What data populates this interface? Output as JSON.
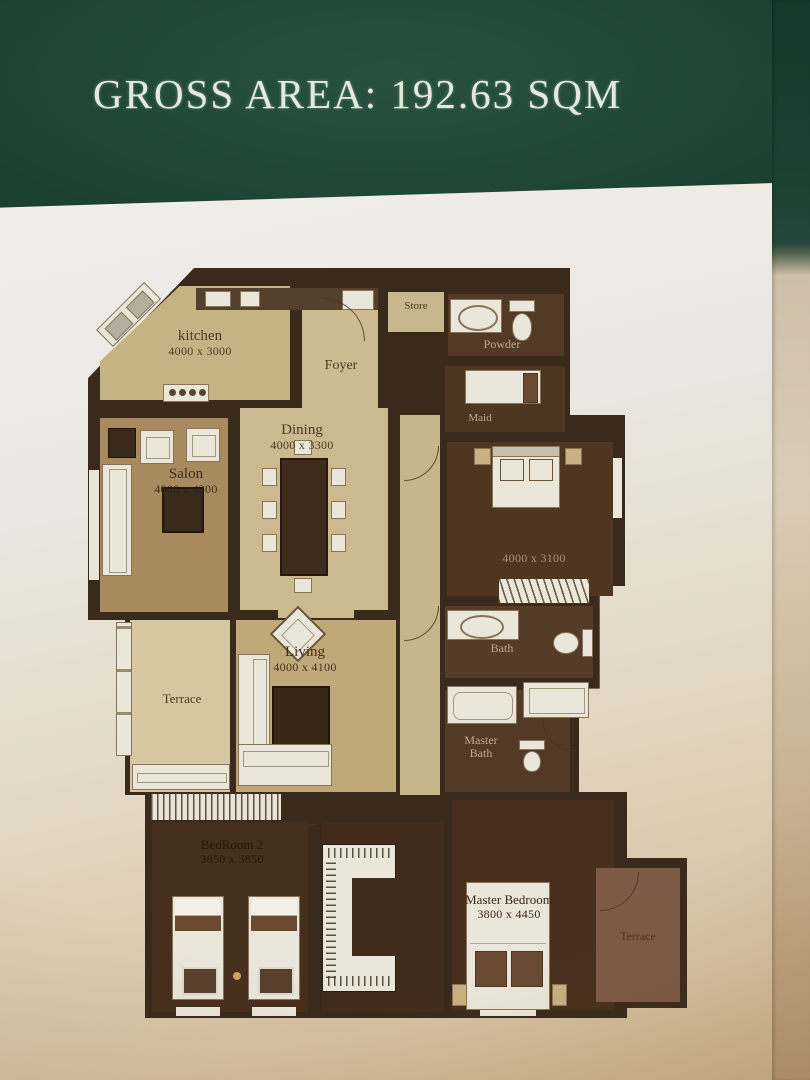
{
  "header": {
    "title": "GROSS AREA: 192.63 SQM"
  },
  "colors": {
    "band_green": "#1e4434",
    "wall_brown": "#3a2a1c",
    "floor_light": "#cdbc92",
    "floor_dark": "#4b3422",
    "furniture_white": "#eae6da",
    "page": "#ece9e2"
  },
  "rooms": {
    "kitchen": {
      "name": "kitchen",
      "dims": "4000 x 3000"
    },
    "foyer": {
      "name": "Foyer"
    },
    "store": {
      "name": "Store"
    },
    "powder": {
      "name": "Powder"
    },
    "maid": {
      "name": "Maid"
    },
    "dining": {
      "name": "Dining",
      "dims": "4000 x 3300"
    },
    "salon": {
      "name": "Salon",
      "dims": "4000 x 4300"
    },
    "terrace_side": {
      "name": "Terrace"
    },
    "living": {
      "name": "Living",
      "dims": "4000 x 4100"
    },
    "bedroom2": {
      "name": "BedRoom 2",
      "dims": "3850 x 3850"
    },
    "bedroom3": {
      "dims": "4000 x 3100"
    },
    "bath": {
      "name": "Bath"
    },
    "master_bath": {
      "name": "Master Bath"
    },
    "master_bedroom": {
      "name": "Master Bedroom",
      "dims": "3800 x 4450"
    },
    "terrace_master": {
      "name": "Terrace"
    }
  }
}
